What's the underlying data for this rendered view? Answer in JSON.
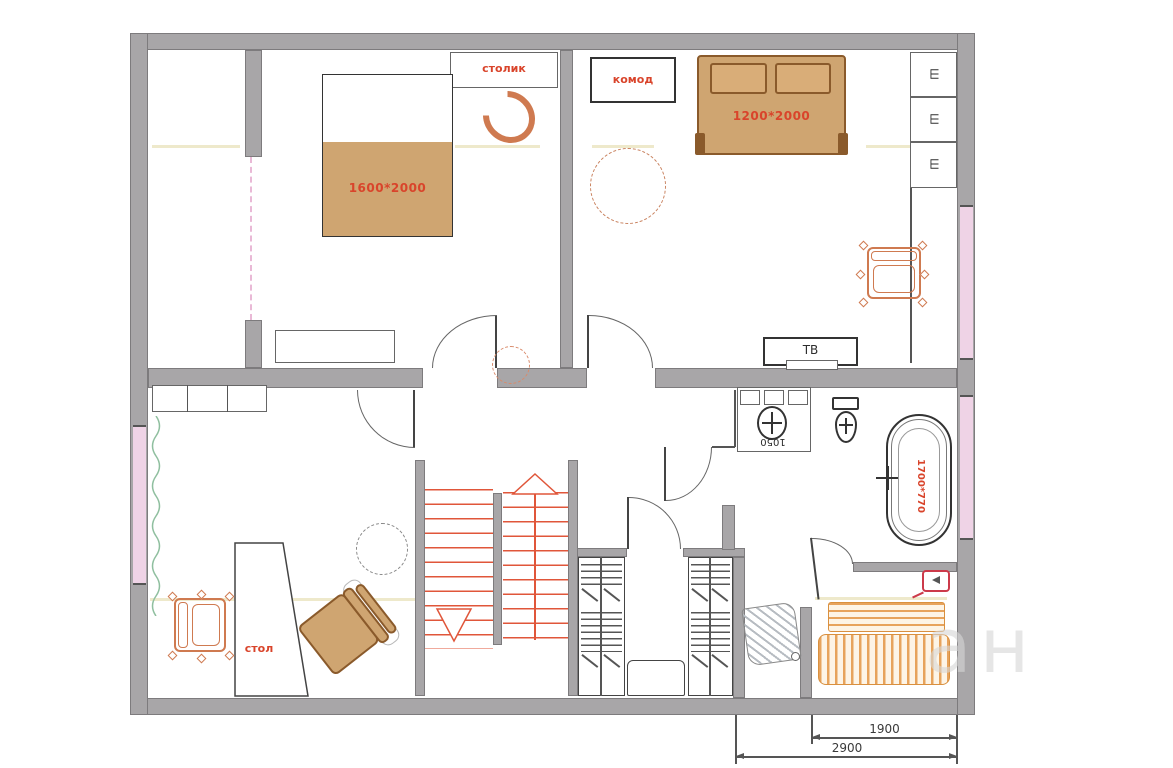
{
  "colors": {
    "wall": "#a8a6a8",
    "wall_edge": "#7d7b7d",
    "line_dark": "#3f3f3f",
    "red_text": "#d9442b",
    "stairs_red": "#e0563a",
    "orange_outline": "#cf7a50",
    "bed_brown": "#cfa571",
    "bed_brown_dark": "#8a5a2b",
    "bench_orange": "#e7a35c",
    "bench_border": "#d9903f",
    "window_pink": "#efd3e6",
    "door_pink": "#e9b9d6",
    "curtain_green": "#8fbf9f",
    "beige": "#ebe5c2",
    "heater_red": "#cc3a4a",
    "watermark": "#d7d7d7"
  },
  "bedroom1": {
    "bed_size": "1600*2000",
    "side_table": "столик"
  },
  "bedroom2": {
    "bed_size": "1200*2000",
    "dresser": "комод",
    "tv": "ТВ",
    "wardrobe_cells": [
      "Ш",
      "Ш",
      "Ш"
    ]
  },
  "living_room": {
    "desk": "стол"
  },
  "bathroom": {
    "vanity_size": "1050",
    "bathtub_size": "1700*770"
  },
  "dimensions": {
    "width_inner": "1900",
    "width_outer": "2900"
  },
  "watermark_text": "ан"
}
